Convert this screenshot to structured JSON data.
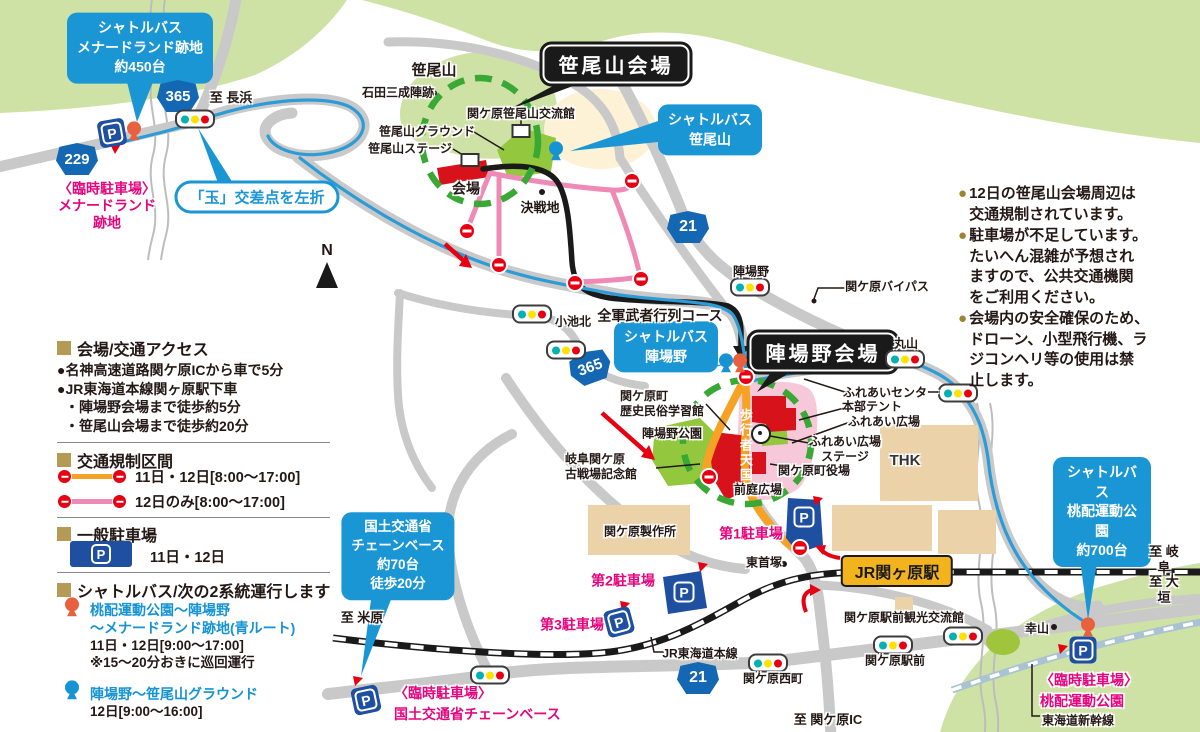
{
  "colors": {
    "shuttle_blue": "#1b96d5",
    "regulation_pink": "#ef8ab6",
    "regulation_orange": "#f6a325",
    "parking_blue": "#1e4fa0",
    "temp_parking_pink": "#e5067e",
    "route_badge_blue": "#1467b3",
    "station_yellow": "#f2b31c",
    "venue_red": "#d8121b",
    "park_green": "#92c73e",
    "hill_green": "#cfe2a6",
    "note_bullet": "#9c8434"
  },
  "icons": {
    "parking": "P",
    "north": "N"
  },
  "badges": {
    "r365": "365",
    "r229": "229",
    "r21": "21"
  },
  "callouts": {
    "menard": "シャトルバス\nメナードランド跡地\n約450台",
    "sasao_shuttle": "シャトルバス\n笹尾山",
    "jinba_shuttle": "シャトルバス\n陣場野",
    "momokubari": "シャトルバス\n桃配運動公園\n約700台",
    "kokudo": "国土交通省\nチェーンベース\n約70台\n徒歩20分",
    "tama": "「玉」交差点を左折",
    "sasao_venue": "笹尾山会場",
    "jinba_venue": "陣場野会場",
    "station": "JR関ヶ原駅"
  },
  "labels": {
    "sasaoyama": "笹尾山",
    "ishida": "石田三成陣跡",
    "koryukan": "関ケ原笹尾山交流館",
    "ground": "笹尾山グラウンド",
    "sasao_stage": "笹尾山ステージ",
    "kaijo": "会場",
    "kessenchi": "決戦地",
    "to_nagahama": "至 長浜",
    "koikekita": "小池北",
    "zengun": "全軍武者行列コース",
    "jinbano": "陣場野",
    "bypass": "関ケ原バイパス",
    "maruyama": "丸山",
    "fureai_center": "ふれあいセンター",
    "honbu_tent": "本部テント",
    "fureai_hiroba": "ふれあい広場",
    "fureai_stage": "ふれあい広場\nステージ",
    "yakuba": "関ケ原町役場",
    "rekishi_kan": "関ケ原町\n歴史民俗学習館",
    "jinbano_park": "陣場野公園",
    "kinenkan": "岐阜関ケ原\n古戦場記念館",
    "zentei": "前庭広場",
    "thk": "THK",
    "hokosha": "歩行者天国",
    "seisakusho": "関ケ原製作所",
    "higashi_kubizuka": "東首塚",
    "jr_tokaido": "JR東海道本線",
    "nishimachi": "関ケ原西町",
    "ekimae_kan": "関ケ原駅前観光交流館",
    "ekimae": "関ケ原駅前",
    "yukiyama": "幸山",
    "shinkansen": "東海道新幹線",
    "to_maibara": "至 米原",
    "to_gifu": "至 岐阜",
    "to_ogaki": "至 大垣",
    "to_ic": "至 関ケ原IC"
  },
  "parking_labels": {
    "p1": "第1駐車場",
    "p2": "第2駐車場",
    "p3": "第3駐車場",
    "menard_tmp": "〈臨時駐車場〉\nメナードランド\n跡地",
    "kokudo_tmp": "〈臨時駐車場〉\n国土交通省チェーンベース",
    "momo_tmp": "〈臨時駐車場〉\n桃配運動公園"
  },
  "notes": {
    "bullet": "●",
    "n1": "12日の笹尾山会場周辺は\n交通規制されています。",
    "n2": "駐車場が不足しています。\nたいへん混雑が予想され\nますので、公共交通機関\nをご利用ください。",
    "n3": "会場内の安全確保のため、\nドローン、小型飛行機、ラ\nジコンヘリ等の使用は禁\n止します。"
  },
  "legend": {
    "access_header": "会場/交通アクセス",
    "access": {
      "l1": "●名神高速道路関ケ原ICから車で5分",
      "l2": "●JR東海道本線関ヶ原駅下車",
      "l3": "・陣場野会場まで徒歩約5分",
      "l4": "・笹尾山会場まで徒歩約20分"
    },
    "regulation_header": "交通規制区間",
    "reg1": "11日・12日[8:00〜17:00]",
    "reg2": "12日のみ[8:00〜17:00]",
    "parking_header": "一般駐車場",
    "parking_days": "11日・12日",
    "shuttle_header": "シャトルバス/次の2系統運行します",
    "shuttle1_name": "桃配運動公園〜陣場野\n〜メナードランド跡地(青ルート)",
    "shuttle1_detail": "11日・12日[9:00〜17:00]\n※15〜20分おきに巡回運行",
    "shuttle2_name": "陣場野〜笹尾山グラウンド",
    "shuttle2_detail": "12日[9:00〜16:00]"
  }
}
